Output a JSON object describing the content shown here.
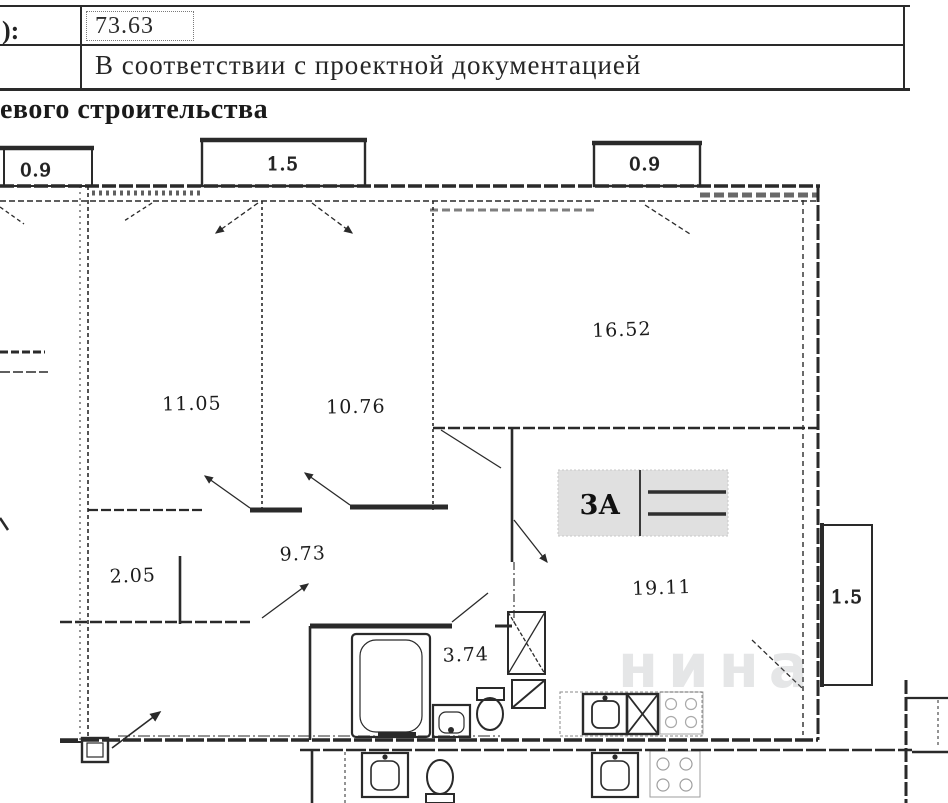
{
  "document": {
    "table": {
      "left_column_fragment": "):",
      "area_value": "73.63",
      "row2_text": "В соответствии с проектной документацией"
    },
    "heading_fragment": "евого строительства"
  },
  "plan": {
    "balconies": [
      {
        "id": "balcony-top-left",
        "area": "0.9"
      },
      {
        "id": "balcony-top-center",
        "area": "1.5"
      },
      {
        "id": "balcony-top-right",
        "area": "0.9"
      },
      {
        "id": "balcony-right",
        "area": "1.5"
      }
    ],
    "rooms": [
      {
        "id": "room-left",
        "area": "11.05"
      },
      {
        "id": "room-middle",
        "area": "10.76"
      },
      {
        "id": "room-top-right",
        "area": "16.52"
      },
      {
        "id": "hallway",
        "area": "9.73"
      },
      {
        "id": "closet",
        "area": "2.05"
      },
      {
        "id": "kitchen-living",
        "area": "19.11"
      },
      {
        "id": "bathroom",
        "area": "3.74"
      }
    ],
    "stamp_label": "3А",
    "watermark_fragment": "нина",
    "colors": {
      "ink": "#2a2a2a",
      "paper": "#ffffff",
      "stamp_background": "#c7c7c7"
    }
  }
}
